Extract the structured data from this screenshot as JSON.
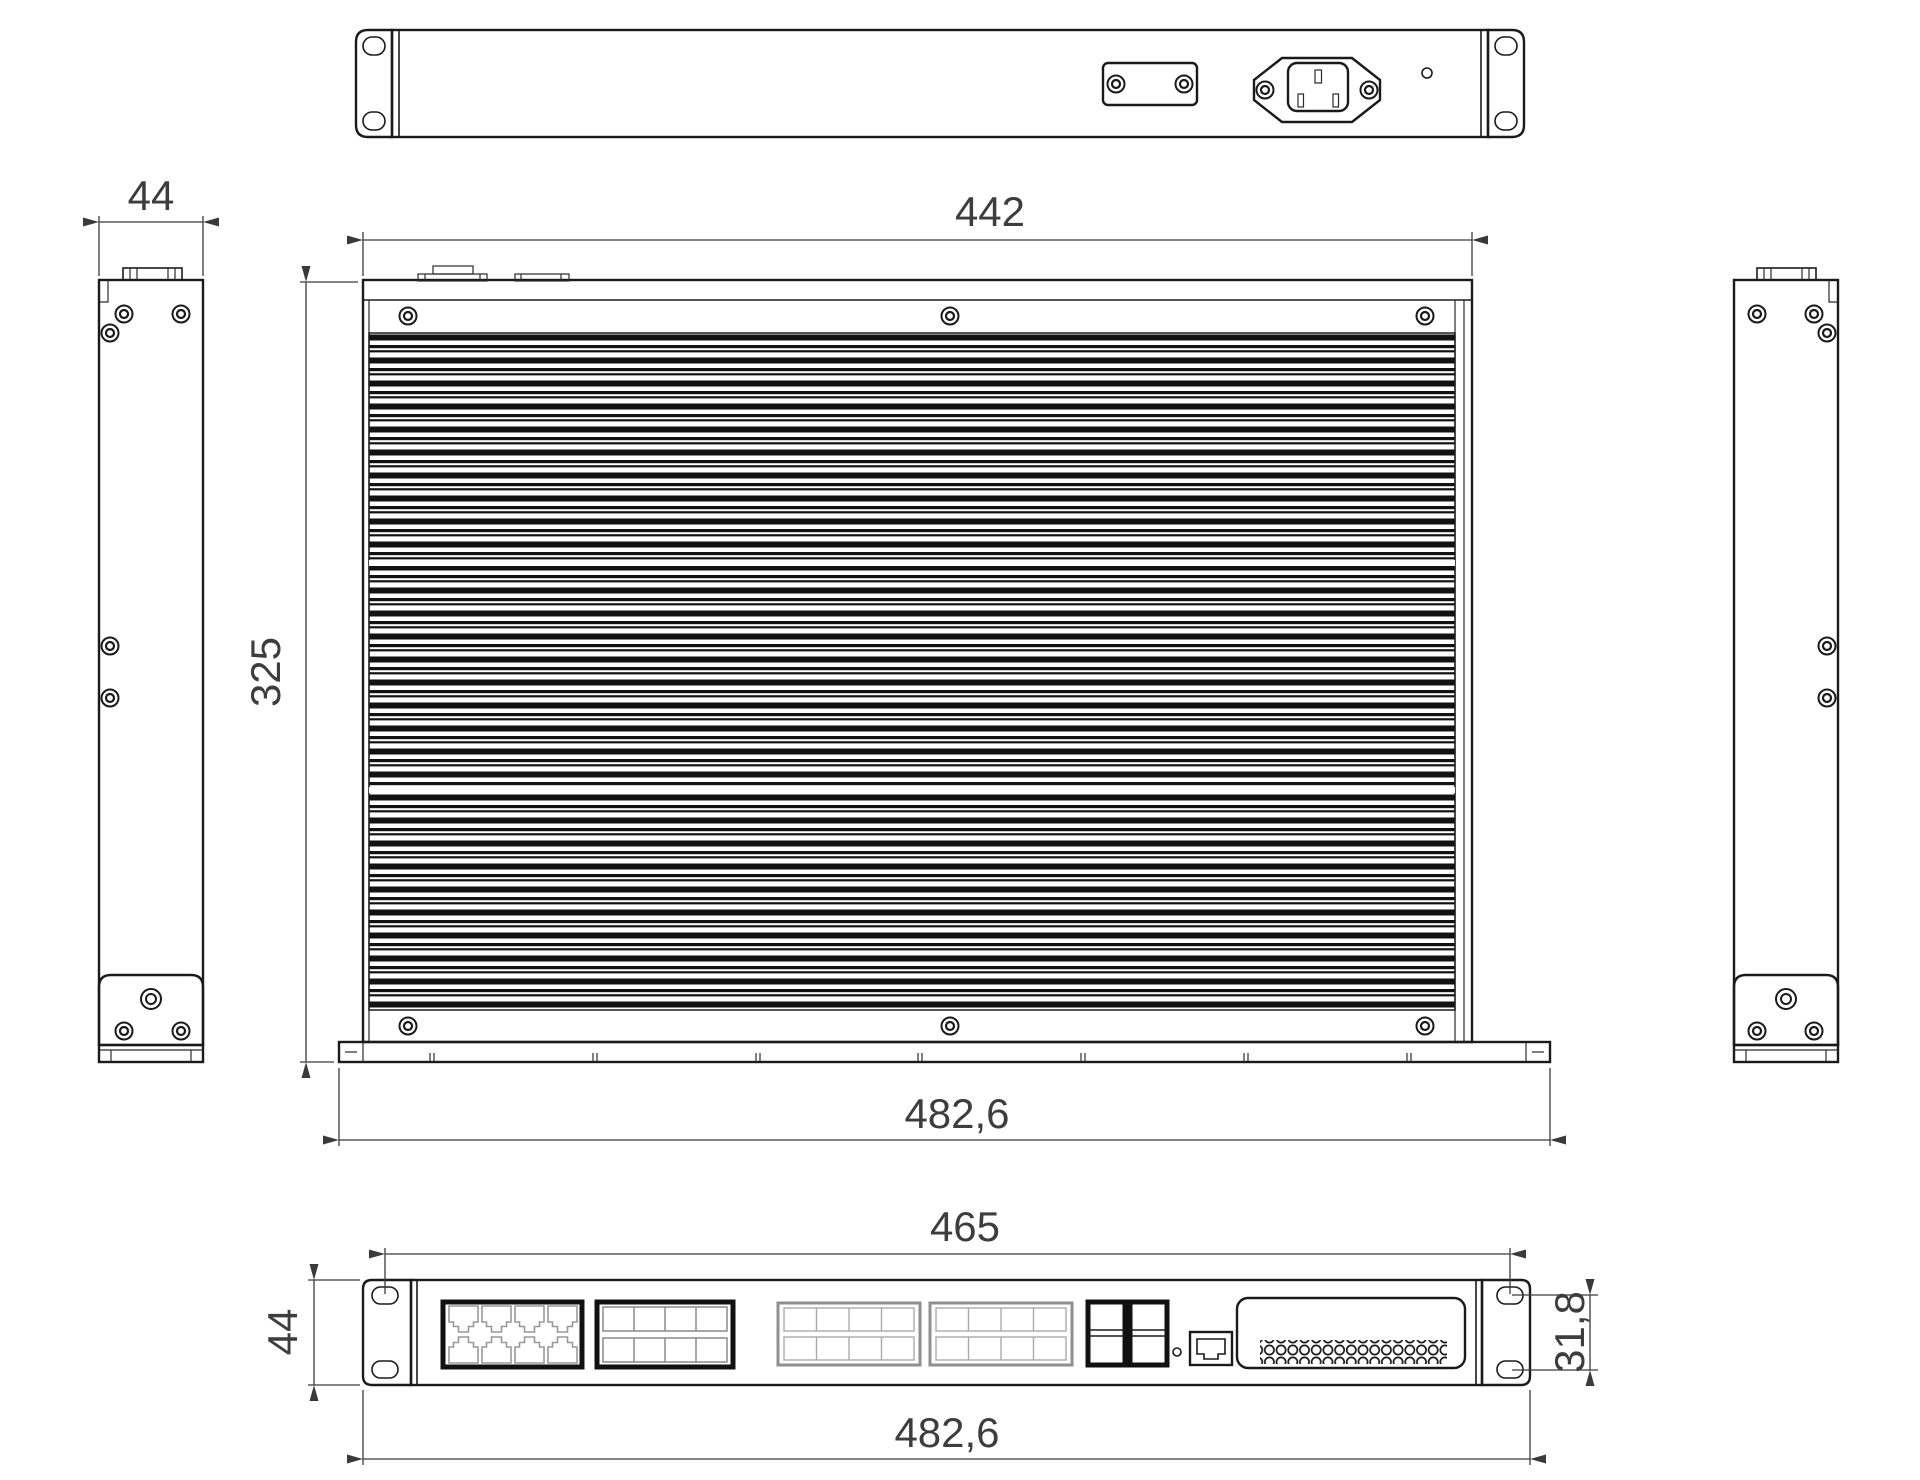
{
  "drawing": {
    "type": "mechanical-dimension-drawing",
    "subject": "19-inch 1U rack-mount network switch, 5 orthographic views",
    "unit_style": "millimetres with comma decimal separator",
    "views": {
      "rear_view": {
        "features": [
          "mounting-ear-slots",
          "blank-cover-plate",
          "iec-c14-power-inlet",
          "pilot-hole"
        ]
      },
      "left_side_view": {
        "width_label": "44"
      },
      "top_view": {
        "body_width_label": "442",
        "body_depth_label": "325",
        "overall_width_label": "482,6"
      },
      "right_side_view": {},
      "front_view": {
        "mount_hole_spacing_label": "465",
        "panel_height_label": "44",
        "ear_slot_spacing_label": "31,8",
        "overall_width_label": "482,6",
        "features": [
          "8x-rj45-block",
          "3x-module-blocks",
          "4x-sfp-cages",
          "status-led",
          "console-rj45",
          "vent-grille",
          "mounting-ear-slots"
        ]
      }
    },
    "dims": {
      "side_width": "44",
      "body_width": "442",
      "body_depth": "325",
      "overall_width_top": "482,6",
      "mount_hole_spacing": "465",
      "front_height": "44",
      "ear_slot_spacing": "31,8",
      "overall_width_front": "482,6"
    },
    "line_colors": {
      "outline": "#1a1a1a",
      "dimension": "#3a3a3a",
      "light_detail": "#9a9a9a"
    }
  }
}
